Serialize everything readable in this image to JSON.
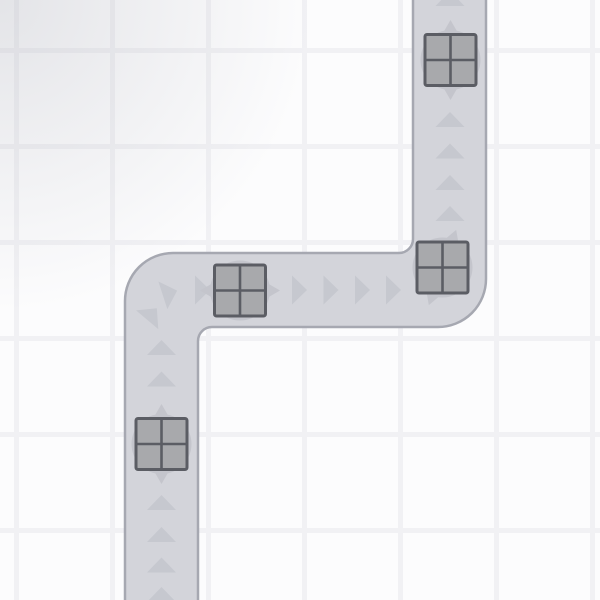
{
  "scene": {
    "title": "conveyor-road-scene",
    "canvas": {
      "width": 600,
      "height": 600
    },
    "background": {
      "color": "#fcfcfd",
      "grid": {
        "spacing": 96,
        "line_width": 5,
        "line_color": "#f1f1f4",
        "offset_x": 14,
        "offset_y": 48
      },
      "vignette": {
        "color": "rgba(176,178,187,0.32)",
        "x": 0,
        "y": 0,
        "radius": 460,
        "fade_pct": 68
      }
    },
    "road": {
      "fill": "#d3d4da",
      "border_color": "#a6a8b1",
      "border_width": 2.5,
      "lane_width": 73,
      "path": "M125,610 L125,301 A48,48 0 0 1 173,253 L399,253 A14,14 0 0 0 413,239 L413,-10 L486,-10 L486,279 A48,48 0 0 1 438,327 L212,327 A14,14 0 0 0 198,341 L198,610 Z"
    },
    "flow_arrows": {
      "color": "#c6c8cf",
      "base": 29,
      "height": 15,
      "items": [
        {
          "x": 450,
          "y": -1.5,
          "rot": 0
        },
        {
          "x": 450,
          "y": 119.5,
          "rot": 0
        },
        {
          "x": 450,
          "y": 151,
          "rot": 0
        },
        {
          "x": 450,
          "y": 182.5,
          "rot": 0
        },
        {
          "x": 450,
          "y": 213.5,
          "rot": 0
        },
        {
          "x": 393.5,
          "y": 290,
          "rot": 90
        },
        {
          "x": 362.5,
          "y": 290,
          "rot": 90
        },
        {
          "x": 331,
          "y": 290,
          "rot": 90
        },
        {
          "x": 299.5,
          "y": 290,
          "rot": 90
        },
        {
          "x": 202.5,
          "y": 290,
          "rot": 90
        },
        {
          "x": 170,
          "y": 293,
          "rot": 72
        },
        {
          "x": 152,
          "y": 314,
          "rot": 40
        },
        {
          "x": 161.5,
          "y": 347.5,
          "rot": 0
        },
        {
          "x": 161.5,
          "y": 379,
          "rot": 0
        },
        {
          "x": 161.5,
          "y": 502.5,
          "rot": 0
        },
        {
          "x": 161.5,
          "y": 534.5,
          "rot": 0
        },
        {
          "x": 161.5,
          "y": 565,
          "rot": 0
        },
        {
          "x": 161.5,
          "y": 594.5,
          "rot": 0
        }
      ]
    },
    "crates": {
      "size": 51,
      "body_fill": "#a8a9ac",
      "border_color": "#5b5d64",
      "border_width": 3,
      "cross_width": 2.6,
      "corner_radius": 2,
      "shadow_color": "#c4c5cc",
      "shadow_radius": 30,
      "diamond_long": 40,
      "diamond_short": 23,
      "items": [
        {
          "x": 450.5,
          "y": 60,
          "rot": 0,
          "label": "crate-top"
        },
        {
          "x": 442.5,
          "y": 267.5,
          "rot": 20,
          "label": "crate-upper-corner"
        },
        {
          "x": 240,
          "y": 290.5,
          "rot": 90,
          "label": "crate-middle"
        },
        {
          "x": 161.5,
          "y": 444,
          "rot": 0,
          "label": "crate-bottom"
        }
      ]
    }
  }
}
